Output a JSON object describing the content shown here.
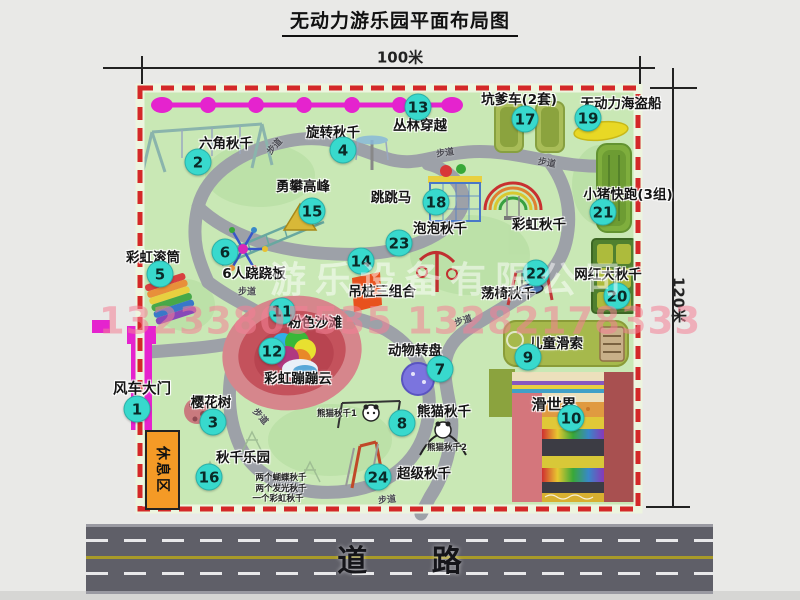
{
  "header": {
    "title": "无动力游乐园平面布局图"
  },
  "dimensions": {
    "width_label": "100米",
    "height_label": "120米"
  },
  "road": {
    "label": "道 路"
  },
  "watermark": {
    "company": "游乐设备有限公司",
    "phones": "13233805535 13282178333"
  },
  "zones": {
    "rest_area": "休息区"
  },
  "colors": {
    "park_green": "#c9e8b5",
    "path_gray": "#9da1a8",
    "border_red": "#d42828",
    "marker_cyan": "#38d9cd",
    "gate_magenta": "#e523ce",
    "zipline_magenta": "#e523ce",
    "rest_area_orange": "#f49a26",
    "road_gray": "#5f5f68",
    "road_line_yellow": "#a89a28",
    "watermark_pink": "#f48096",
    "beach_pink": "#d6868c",
    "pirate_yellow": "#e8d825"
  },
  "map": {
    "items": [
      {
        "num": "1",
        "name": "风车大门",
        "cx": 137,
        "cy": 409,
        "lx": 142,
        "ly": 388,
        "size": 14.5
      },
      {
        "num": "2",
        "name": "六角秋千",
        "cx": 198,
        "cy": 162,
        "lx": 226,
        "ly": 142
      },
      {
        "num": "3",
        "name": "樱花树",
        "cx": 213,
        "cy": 422,
        "lx": 211,
        "ly": 401
      },
      {
        "num": "4",
        "name": "旋转秋千",
        "cx": 343,
        "cy": 150,
        "lx": 333,
        "ly": 131
      },
      {
        "num": "5",
        "name": "彩虹滚筒",
        "cx": 160,
        "cy": 274,
        "lx": 153,
        "ly": 256
      },
      {
        "num": "6",
        "name": "6人跷跷板",
        "cx": 225,
        "cy": 252,
        "lx": 254,
        "ly": 272
      },
      {
        "num": "7",
        "name": "动物转盘",
        "cx": 440,
        "cy": 369,
        "lx": 415,
        "ly": 349
      },
      {
        "num": "8",
        "name": "熊猫秋千",
        "cx": 402,
        "cy": 423,
        "lx": 444,
        "ly": 410,
        "notes": [
          {
            "text": "熊猫秋千1",
            "x": 337,
            "y": 413
          },
          {
            "text": "熊猫秋千2",
            "x": 447,
            "y": 447
          }
        ]
      },
      {
        "num": "9",
        "name": "儿童滑索",
        "cx": 528,
        "cy": 357,
        "lx": 556,
        "ly": 342
      },
      {
        "num": "10",
        "name": "滑世界",
        "cx": 571,
        "cy": 418,
        "lx": 554,
        "ly": 404,
        "size": 15
      },
      {
        "num": "11",
        "name": "粉色沙滩",
        "cx": 282,
        "cy": 311,
        "lx": 315,
        "ly": 321
      },
      {
        "num": "12",
        "name": "彩虹蹦蹦云",
        "cx": 272,
        "cy": 351,
        "lx": 298,
        "ly": 377
      },
      {
        "num": "13",
        "name": "丛林穿越",
        "cx": 418,
        "cy": 107,
        "lx": 420,
        "ly": 124
      },
      {
        "num": "14",
        "name": "吊桩三组合",
        "cx": 361,
        "cy": 261,
        "lx": 382,
        "ly": 290
      },
      {
        "num": "15",
        "name": "勇攀高峰",
        "cx": 312,
        "cy": 211,
        "lx": 303,
        "ly": 185
      },
      {
        "num": "16",
        "name": "秋千乐园",
        "cx": 209,
        "cy": 477,
        "lx": 243,
        "ly": 456,
        "notes": [
          {
            "text": "两个蝴蝶秋千",
            "x": 281,
            "y": 477
          },
          {
            "text": "两个发光秋千",
            "x": 281,
            "y": 488
          },
          {
            "text": "一个彩虹秋千",
            "x": 278,
            "y": 498
          }
        ]
      },
      {
        "num": "17",
        "name": "坑爹车(2套)",
        "cx": 525,
        "cy": 119,
        "lx": 519,
        "ly": 98
      },
      {
        "num": "18",
        "name": "跳跳马",
        "cx": 436,
        "cy": 202,
        "lx": 391,
        "ly": 196
      },
      {
        "num": "19",
        "name": "无动力海盗船",
        "cx": 588,
        "cy": 118,
        "lx": 621,
        "ly": 102
      },
      {
        "num": "20",
        "name": "网红大秋千",
        "cx": 617,
        "cy": 296,
        "lx": 608,
        "ly": 273
      },
      {
        "num": "21",
        "name": "小猪快跑(3组)",
        "cx": 603,
        "cy": 212,
        "lx": 628,
        "ly": 193
      },
      {
        "num": "22",
        "name": "荡椅秋千",
        "cx": 536,
        "cy": 273,
        "lx": 508,
        "ly": 292
      },
      {
        "num": "23",
        "name": "泡泡秋千",
        "cx": 399,
        "cy": 243,
        "lx": 440,
        "ly": 227
      },
      {
        "num": "24",
        "name": "超级秋千",
        "cx": 378,
        "cy": 477,
        "lx": 424,
        "ly": 472
      },
      {
        "num": "",
        "name": "彩虹秋千",
        "cx": 0,
        "cy": 0,
        "lx": 539,
        "ly": 223
      }
    ],
    "path_labels": [
      {
        "text": "步道",
        "x": 274,
        "y": 146,
        "rot": -48
      },
      {
        "text": "步道",
        "x": 445,
        "y": 152,
        "rot": -8
      },
      {
        "text": "步道",
        "x": 547,
        "y": 162,
        "rot": 10
      },
      {
        "text": "步道",
        "x": 247,
        "y": 291,
        "rot": 0
      },
      {
        "text": "步道",
        "x": 463,
        "y": 320,
        "rot": -18
      },
      {
        "text": "步道",
        "x": 261,
        "y": 416,
        "rot": 48
      },
      {
        "text": "步道",
        "x": 387,
        "y": 499,
        "rot": -6
      }
    ]
  }
}
